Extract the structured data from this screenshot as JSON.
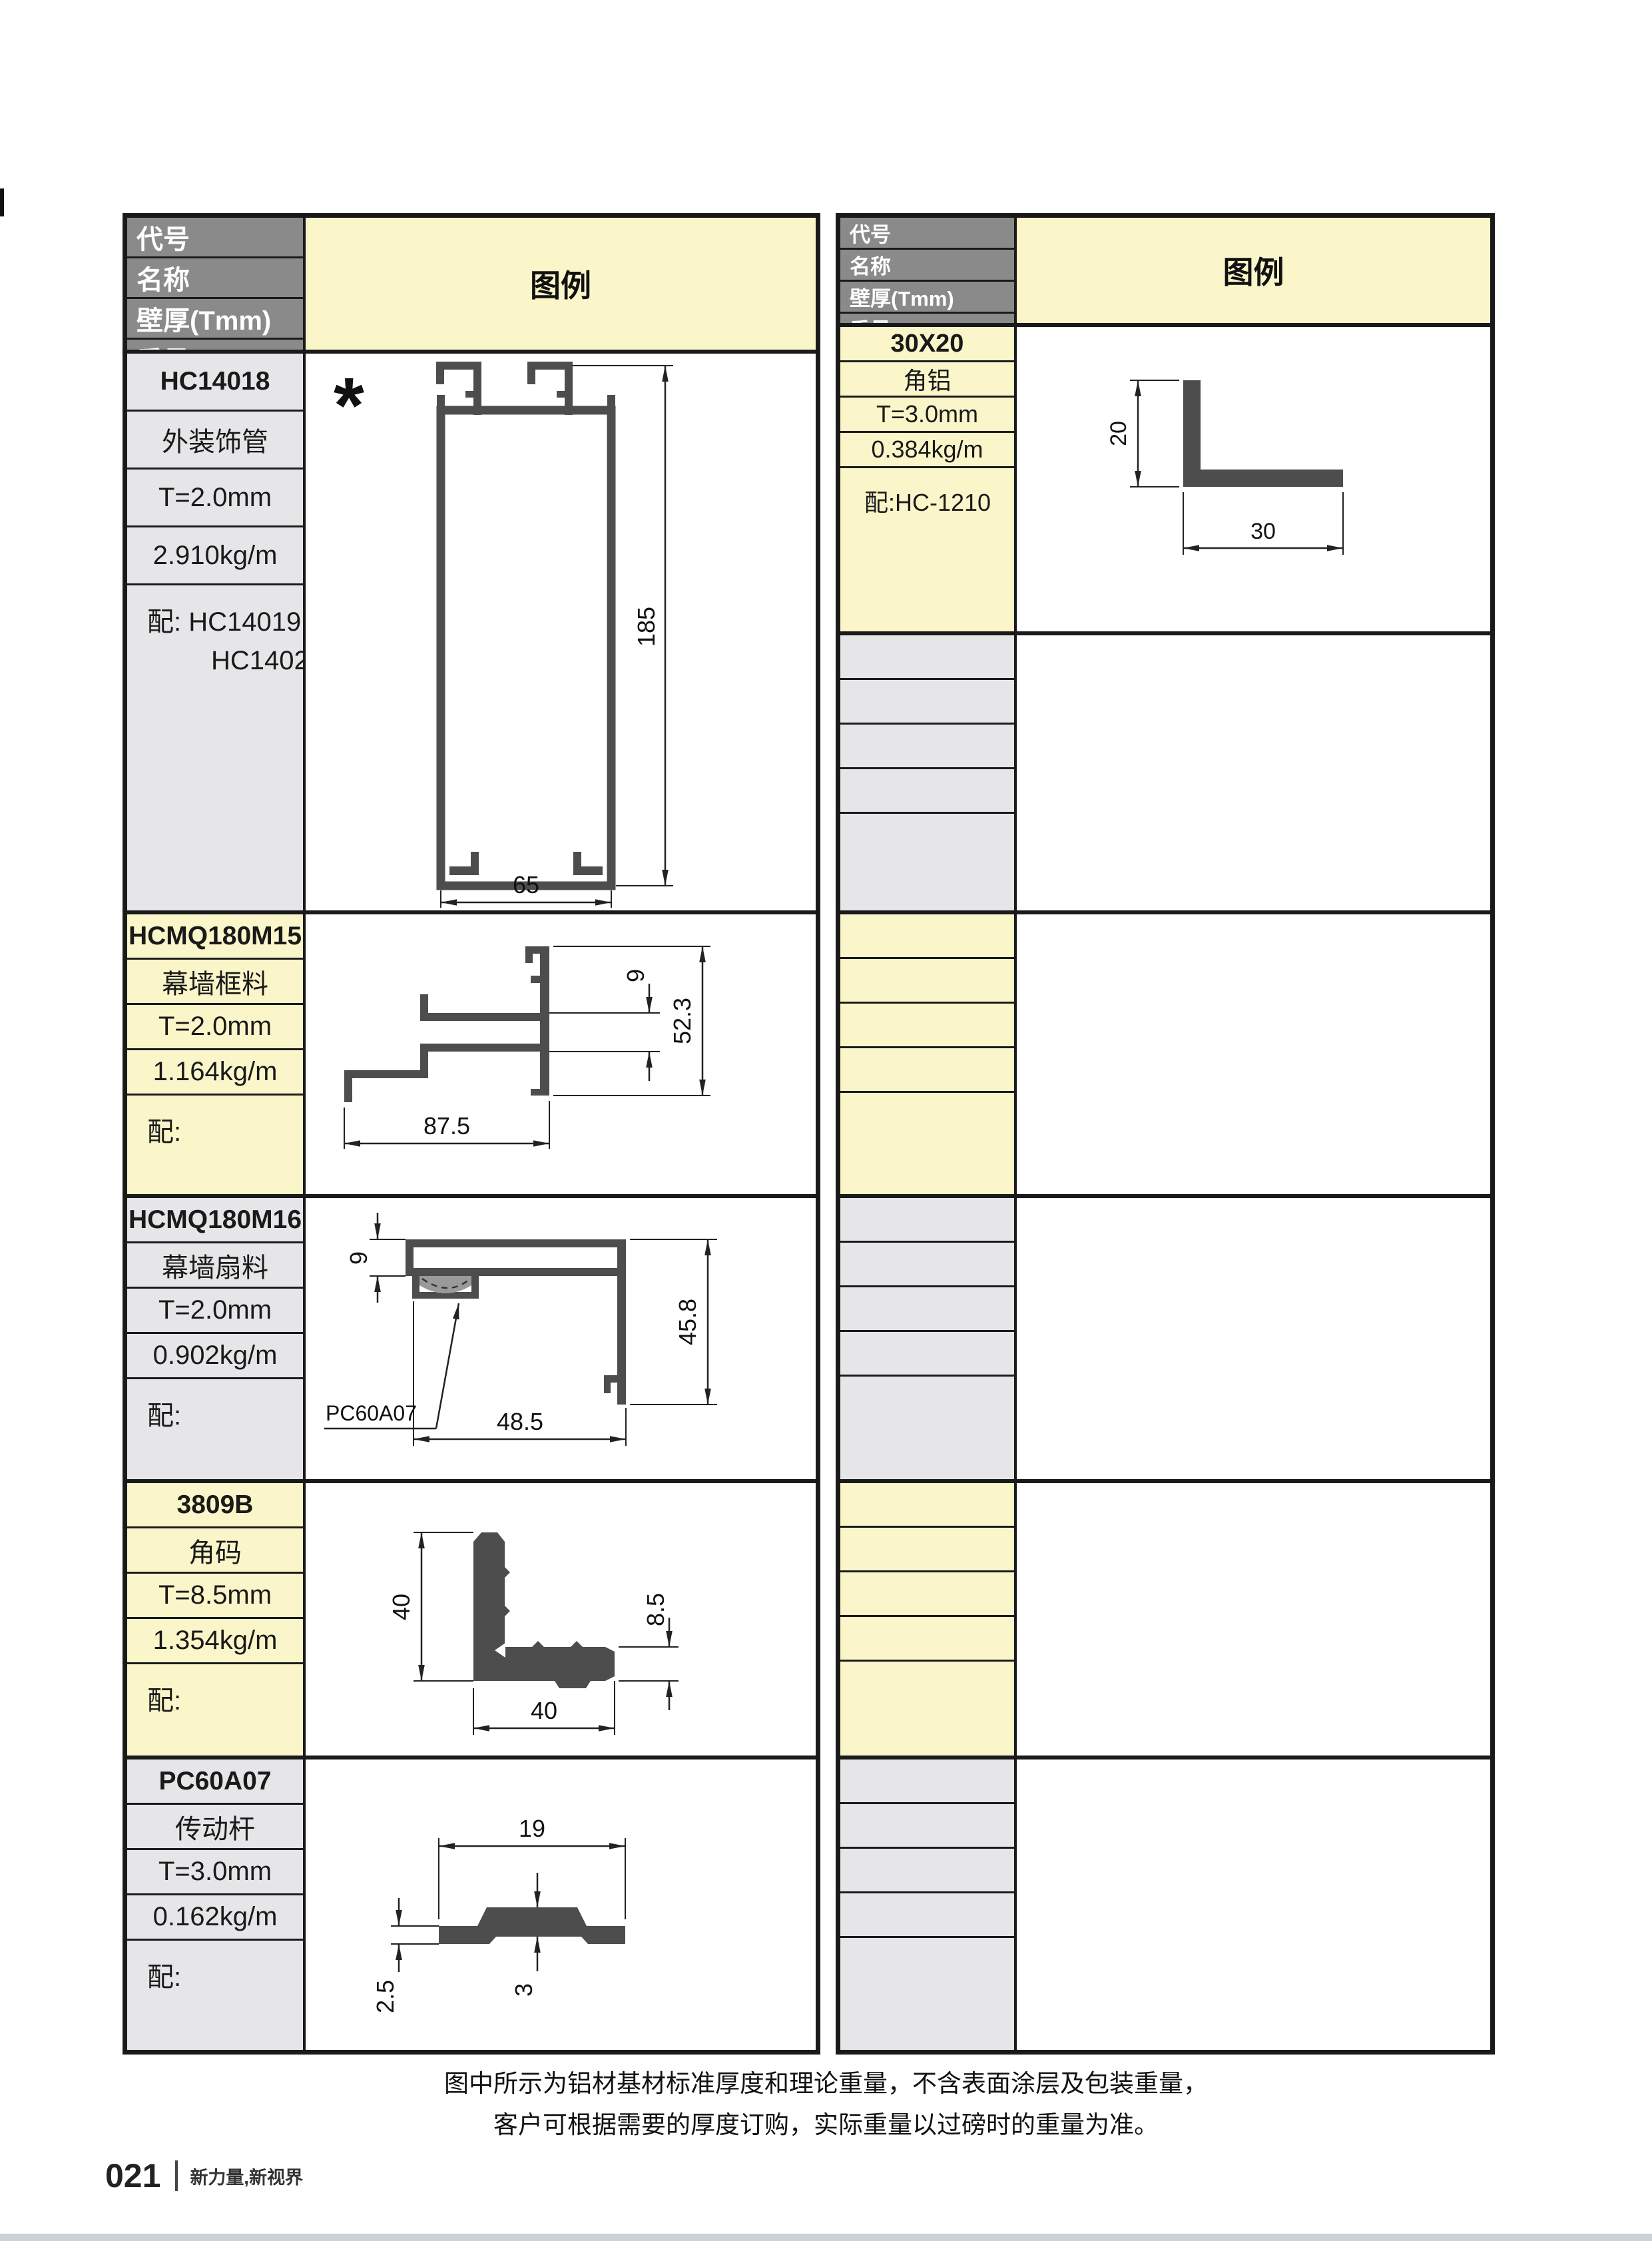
{
  "page": {
    "note_line1": "图中所示为铝材基材标准厚度和理论重量，不含表面涂层及包装重量，",
    "note_line2": "客户可根据需要的厚度订购，实际重量以过磅时的重量为准。",
    "footer": {
      "page_number": "021",
      "slogan": "新力量,新视界"
    }
  },
  "colors": {
    "header_bg": "#8a8a8a",
    "row_yellow": "#fbf6c9",
    "row_gray": "#e6e5e7",
    "profile_fill": "#4d4d4d",
    "border": "#1a1a1a",
    "bottom_strip": "#cfd2d4"
  },
  "header_labels": {
    "code": "代号",
    "name": "名称",
    "thickness": "壁厚(Tmm)",
    "weight": "重量(kg/m)",
    "accessory": "配套",
    "legend": "图例"
  },
  "left_table": {
    "rows": [
      {
        "code": "HC14018",
        "name": "外装饰管",
        "thickness": "T=2.0mm",
        "weight": "2.910kg/m",
        "accessory_line1": "配: HC14019",
        "accessory_line2": "HC14024",
        "marker": "*",
        "dims": {
          "height": "185",
          "width": "65"
        }
      },
      {
        "code": "HCMQ180M15",
        "name": "幕墙框料",
        "thickness": "T=2.0mm",
        "weight": "1.164kg/m",
        "accessory_line1": "配:",
        "dims": {
          "width": "87.5",
          "height": "52.3",
          "channel": "9"
        }
      },
      {
        "code": "HCMQ180M16",
        "name": "幕墙扇料",
        "thickness": "T=2.0mm",
        "weight": "0.902kg/m",
        "accessory_line1": "配:",
        "dims": {
          "channel": "9",
          "height": "45.8",
          "width": "48.5",
          "leader_label": "PC60A07"
        }
      },
      {
        "code": "3809B",
        "name": "角码",
        "thickness": "T=8.5mm",
        "weight": "1.354kg/m",
        "accessory_line1": "配:",
        "dims": {
          "height": "40",
          "width": "40",
          "thickness": "8.5"
        }
      },
      {
        "code": "PC60A07",
        "name": "传动杆",
        "thickness": "T=3.0mm",
        "weight": "0.162kg/m",
        "accessory_line1": "配:",
        "dims": {
          "width": "19",
          "edge_height": "2.5",
          "center_height": "3"
        }
      }
    ]
  },
  "right_table": {
    "rows": [
      {
        "code": "30X20",
        "name": "角铝",
        "thickness": "T=3.0mm",
        "weight": "0.384kg/m",
        "accessory_line1": "配:HC-1210",
        "dims": {
          "height": "20",
          "width": "30"
        }
      }
    ]
  }
}
